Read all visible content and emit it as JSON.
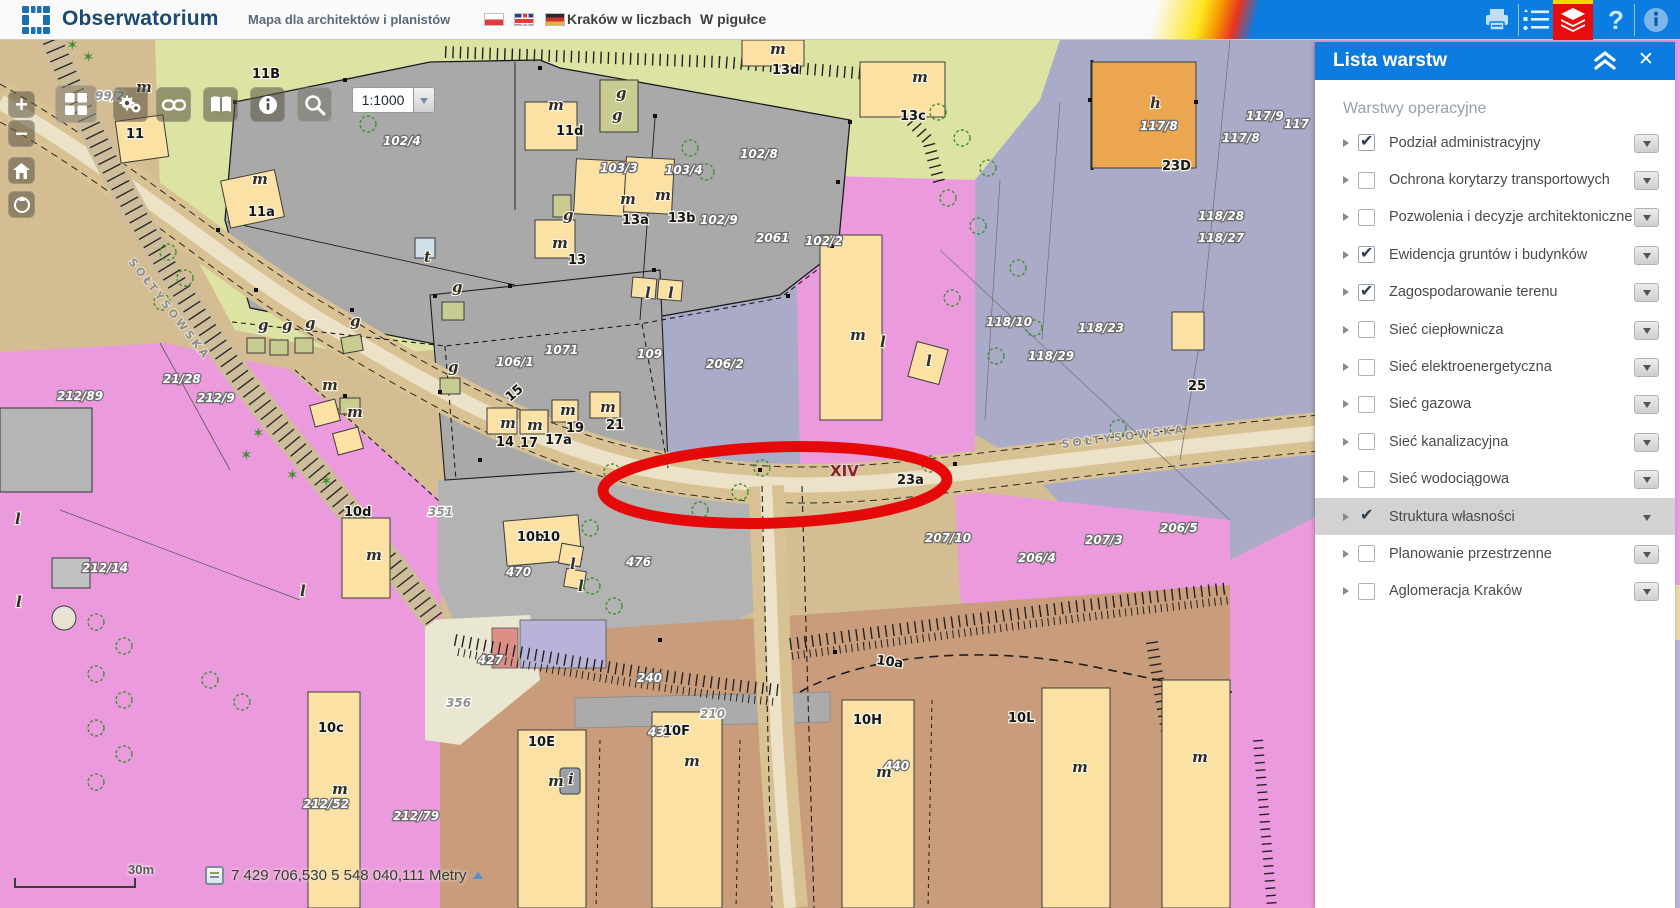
{
  "header": {
    "app_title": "Obserwatorium",
    "subtitle": "Mapa dla architektów i planistów",
    "link_numbers": "Kraków w liczbach",
    "link_pill": "W pigułce",
    "flags": [
      "flag-poland",
      "flag-uk",
      "flag-germany"
    ],
    "icons": [
      "print-icon",
      "legend-icon",
      "layers-icon",
      "help-icon",
      "info-icon"
    ],
    "accent_blue": "#0b7ce0",
    "layers_button_red": "#e80c0c"
  },
  "toolbar": {
    "scale_value": "1:1000",
    "buttons": [
      "zoom-in",
      "zoom-out",
      "home",
      "compass",
      "basemaps-grid",
      "tools-gears",
      "link",
      "book",
      "info",
      "search"
    ]
  },
  "layers_panel": {
    "title": "Lista warstw",
    "section_title": "Warstwy operacyjne",
    "layers": [
      {
        "label": "Podział administracyjny",
        "checked": true,
        "selected": false
      },
      {
        "label": "Ochrona korytarzy transportowych",
        "checked": false,
        "selected": false
      },
      {
        "label": "Pozwolenia i decyzje architektoniczne",
        "checked": false,
        "selected": false
      },
      {
        "label": "Ewidencja gruntów i budynków",
        "checked": true,
        "selected": false
      },
      {
        "label": "Zagospodarowanie terenu",
        "checked": true,
        "selected": false
      },
      {
        "label": "Sieć ciepłownicza",
        "checked": false,
        "selected": false
      },
      {
        "label": "Sieć elektroenergetyczna",
        "checked": false,
        "selected": false
      },
      {
        "label": "Sieć gazowa",
        "checked": false,
        "selected": false
      },
      {
        "label": "Sieć kanalizacyjna",
        "checked": false,
        "selected": false
      },
      {
        "label": "Sieć wodociągowa",
        "checked": false,
        "selected": false
      },
      {
        "label": "Struktura własności",
        "checked": true,
        "selected": true
      },
      {
        "label": "Planowanie przestrzenne",
        "checked": false,
        "selected": false
      },
      {
        "label": "Aglomeracja Kraków",
        "checked": false,
        "selected": false
      }
    ]
  },
  "statusbar": {
    "scalebar_label": "30m",
    "coordinates": "7 429 706,530  5 548 040,111 Metry"
  },
  "map": {
    "annotation_color": "#e60909",
    "colors": {
      "olive": "#dce3a3",
      "gray": "#a9a9a9",
      "tan": "#d4bd92",
      "road": "#d8c193",
      "pink": "#ec9ade",
      "lavender": "#a9abc9",
      "brown": "#c99c7b",
      "building_yellow": "#fbe1a3",
      "building_orange": "#eca64f",
      "building_olive": "#c9cc90"
    },
    "street_labels": [
      {
        "t": "SOŁTYSOWSKA",
        "x": 128,
        "y": 222,
        "r": 52,
        "c": "ls"
      },
      {
        "t": "SOŁTYSOWSKA",
        "x": 1062,
        "y": 408,
        "r": -7,
        "c": "ls"
      }
    ],
    "labels": [
      {
        "t": "99/2",
        "x": 95,
        "y": 60,
        "c": "lg"
      },
      {
        "t": "m",
        "x": 136,
        "y": 52,
        "c": "lm"
      },
      {
        "t": "11",
        "x": 126,
        "y": 98,
        "c": "lb"
      },
      {
        "t": "m",
        "x": 252,
        "y": 144,
        "c": "lm"
      },
      {
        "t": "11a",
        "x": 248,
        "y": 176,
        "c": "lb"
      },
      {
        "t": "11B",
        "x": 252,
        "y": 38,
        "c": "lb"
      },
      {
        "t": "102/4",
        "x": 383,
        "y": 105,
        "c": "lp"
      },
      {
        "t": "m",
        "x": 548,
        "y": 70,
        "c": "lm"
      },
      {
        "t": "11d",
        "x": 556,
        "y": 95,
        "c": "lb"
      },
      {
        "t": "g",
        "x": 616,
        "y": 58,
        "c": "lm"
      },
      {
        "t": "g",
        "x": 612,
        "y": 80,
        "c": "lm"
      },
      {
        "t": "103/3",
        "x": 600,
        "y": 132,
        "c": "lp"
      },
      {
        "t": "103/4",
        "x": 665,
        "y": 134,
        "c": "lp"
      },
      {
        "t": "102/8",
        "x": 740,
        "y": 118,
        "c": "lp"
      },
      {
        "t": "102/9",
        "x": 700,
        "y": 184,
        "c": "lp"
      },
      {
        "t": "102/2",
        "x": 805,
        "y": 205,
        "c": "lp"
      },
      {
        "t": "g",
        "x": 563,
        "y": 180,
        "c": "lm"
      },
      {
        "t": "m",
        "x": 552,
        "y": 208,
        "c": "lm"
      },
      {
        "t": "13",
        "x": 568,
        "y": 224,
        "c": "lb"
      },
      {
        "t": "m",
        "x": 620,
        "y": 164,
        "c": "lm"
      },
      {
        "t": "13a",
        "x": 622,
        "y": 184,
        "c": "lb"
      },
      {
        "t": "m",
        "x": 655,
        "y": 160,
        "c": "lm"
      },
      {
        "t": "13b",
        "x": 668,
        "y": 182,
        "c": "lb"
      },
      {
        "t": "m",
        "x": 770,
        "y": 14,
        "c": "lm"
      },
      {
        "t": "13d",
        "x": 772,
        "y": 34,
        "c": "lb"
      },
      {
        "t": "m",
        "x": 912,
        "y": 42,
        "c": "lm"
      },
      {
        "t": "13c",
        "x": 900,
        "y": 80,
        "c": "lb"
      },
      {
        "t": "t",
        "x": 424,
        "y": 222,
        "c": "lm"
      },
      {
        "t": "h",
        "x": 1150,
        "y": 68,
        "c": "lm"
      },
      {
        "t": "23D",
        "x": 1162,
        "y": 130,
        "c": "lb"
      },
      {
        "t": "117/8",
        "x": 1140,
        "y": 90,
        "c": "lp"
      },
      {
        "t": "117/9",
        "x": 1246,
        "y": 80,
        "c": "lp"
      },
      {
        "t": "117",
        "x": 1284,
        "y": 88,
        "c": "lp"
      },
      {
        "t": "117/8",
        "x": 1222,
        "y": 102,
        "c": "lp"
      },
      {
        "t": "118/28",
        "x": 1198,
        "y": 180,
        "c": "lp"
      },
      {
        "t": "118/27",
        "x": 1198,
        "y": 202,
        "c": "lp"
      },
      {
        "t": "118/10",
        "x": 986,
        "y": 286,
        "c": "lp"
      },
      {
        "t": "118/23",
        "x": 1078,
        "y": 292,
        "c": "lp"
      },
      {
        "t": "118/29",
        "x": 1028,
        "y": 320,
        "c": "lp"
      },
      {
        "t": "25",
        "x": 1188,
        "y": 350,
        "c": "lb"
      },
      {
        "t": "2061",
        "x": 756,
        "y": 202,
        "c": "lp"
      },
      {
        "t": "206/2",
        "x": 706,
        "y": 328,
        "c": "lp"
      },
      {
        "t": "109",
        "x": 637,
        "y": 318,
        "c": "lp"
      },
      {
        "t": "1071",
        "x": 545,
        "y": 314,
        "c": "lp"
      },
      {
        "t": "106/1",
        "x": 496,
        "y": 326,
        "c": "lp"
      },
      {
        "t": "15",
        "x": 510,
        "y": 362,
        "c": "lb",
        "r": -40
      },
      {
        "t": "g",
        "x": 258,
        "y": 290,
        "c": "lm"
      },
      {
        "t": "g",
        "x": 282,
        "y": 290,
        "c": "lm"
      },
      {
        "t": "g",
        "x": 305,
        "y": 288,
        "c": "lm"
      },
      {
        "t": "g",
        "x": 350,
        "y": 286,
        "c": "lm"
      },
      {
        "t": "g",
        "x": 452,
        "y": 252,
        "c": "lm"
      },
      {
        "t": "g",
        "x": 448,
        "y": 332,
        "c": "lm"
      },
      {
        "t": "m",
        "x": 322,
        "y": 350,
        "c": "lm"
      },
      {
        "t": "m",
        "x": 347,
        "y": 377,
        "c": "lm"
      },
      {
        "t": "m",
        "x": 500,
        "y": 388,
        "c": "lm"
      },
      {
        "t": "14",
        "x": 496,
        "y": 406,
        "c": "lb"
      },
      {
        "t": "m",
        "x": 527,
        "y": 390,
        "c": "lm"
      },
      {
        "t": "17",
        "x": 520,
        "y": 407,
        "c": "lb"
      },
      {
        "t": "17a",
        "x": 545,
        "y": 404,
        "c": "lb"
      },
      {
        "t": "m",
        "x": 560,
        "y": 375,
        "c": "lm"
      },
      {
        "t": "19",
        "x": 566,
        "y": 392,
        "c": "lb"
      },
      {
        "t": "m",
        "x": 600,
        "y": 372,
        "c": "lm"
      },
      {
        "t": "21",
        "x": 606,
        "y": 389,
        "c": "lb"
      },
      {
        "t": "l",
        "x": 645,
        "y": 258,
        "c": "lm"
      },
      {
        "t": "l",
        "x": 668,
        "y": 258,
        "c": "lm"
      },
      {
        "t": "XIV",
        "x": 830,
        "y": 436,
        "c": "lx"
      },
      {
        "t": "23a",
        "x": 897,
        "y": 444,
        "c": "lb"
      },
      {
        "t": "m",
        "x": 850,
        "y": 300,
        "c": "lm"
      },
      {
        "t": "l",
        "x": 880,
        "y": 307,
        "c": "lm"
      },
      {
        "t": "l",
        "x": 926,
        "y": 326,
        "c": "lm"
      },
      {
        "t": "207/10",
        "x": 925,
        "y": 502,
        "c": "lp"
      },
      {
        "t": "207/3",
        "x": 1085,
        "y": 504,
        "c": "lp"
      },
      {
        "t": "206/5",
        "x": 1160,
        "y": 492,
        "c": "lp"
      },
      {
        "t": "206/4",
        "x": 1018,
        "y": 522,
        "c": "lp"
      },
      {
        "t": "21/28",
        "x": 163,
        "y": 343,
        "c": "lp"
      },
      {
        "t": "212/89",
        "x": 57,
        "y": 360,
        "c": "lp"
      },
      {
        "t": "212/9",
        "x": 197,
        "y": 362,
        "c": "lp"
      },
      {
        "t": "10d",
        "x": 344,
        "y": 476,
        "c": "lb"
      },
      {
        "t": "m",
        "x": 366,
        "y": 520,
        "c": "lm"
      },
      {
        "t": "212/14",
        "x": 82,
        "y": 532,
        "c": "lp"
      },
      {
        "t": "l",
        "x": 300,
        "y": 556,
        "c": "lm"
      },
      {
        "t": "l",
        "x": 16,
        "y": 567,
        "c": "lm"
      },
      {
        "t": "l",
        "x": 15,
        "y": 484,
        "c": "lm"
      },
      {
        "t": "10b",
        "x": 517,
        "y": 501,
        "c": "lb"
      },
      {
        "t": "10",
        "x": 542,
        "y": 501,
        "c": "lb"
      },
      {
        "t": "l",
        "x": 570,
        "y": 529,
        "c": "lm"
      },
      {
        "t": "l",
        "x": 578,
        "y": 551,
        "c": "lm"
      },
      {
        "t": "476",
        "x": 626,
        "y": 526,
        "c": "lp"
      },
      {
        "t": "470",
        "x": 506,
        "y": 536,
        "c": "lp"
      },
      {
        "t": "351",
        "x": 428,
        "y": 476,
        "c": "lg"
      },
      {
        "t": "427",
        "x": 478,
        "y": 624,
        "c": "lp"
      },
      {
        "t": "356",
        "x": 446,
        "y": 667,
        "c": "lg"
      },
      {
        "t": "240",
        "x": 637,
        "y": 642,
        "c": "lp"
      },
      {
        "t": "210",
        "x": 700,
        "y": 678,
        "c": "lg"
      },
      {
        "t": "437",
        "x": 648,
        "y": 696,
        "c": "lp"
      },
      {
        "t": "10a",
        "x": 876,
        "y": 624,
        "c": "lb",
        "r": 8
      },
      {
        "t": "440",
        "x": 884,
        "y": 730,
        "c": "lp"
      },
      {
        "t": "10E",
        "x": 528,
        "y": 706,
        "c": "lb"
      },
      {
        "t": "m",
        "x": 548,
        "y": 746,
        "c": "lm"
      },
      {
        "t": "10F",
        "x": 663,
        "y": 695,
        "c": "lb"
      },
      {
        "t": "m",
        "x": 684,
        "y": 726,
        "c": "lm"
      },
      {
        "t": "10H",
        "x": 853,
        "y": 684,
        "c": "lb"
      },
      {
        "t": "m",
        "x": 876,
        "y": 737,
        "c": "lm"
      },
      {
        "t": "10L",
        "x": 1008,
        "y": 682,
        "c": "lb"
      },
      {
        "t": "m",
        "x": 1072,
        "y": 732,
        "c": "lm"
      },
      {
        "t": "m",
        "x": 1192,
        "y": 722,
        "c": "lm"
      },
      {
        "t": "i",
        "x": 568,
        "y": 744,
        "c": "lm"
      },
      {
        "t": "10c",
        "x": 318,
        "y": 692,
        "c": "lb"
      },
      {
        "t": "m",
        "x": 332,
        "y": 754,
        "c": "lm"
      },
      {
        "t": "212/52",
        "x": 303,
        "y": 768,
        "c": "lp"
      },
      {
        "t": "212/79",
        "x": 393,
        "y": 780,
        "c": "lp"
      }
    ],
    "trees": [
      [
        168,
        212
      ],
      [
        185,
        238
      ],
      [
        162,
        262
      ],
      [
        388,
        58
      ],
      [
        368,
        84
      ],
      [
        690,
        108
      ],
      [
        706,
        132
      ],
      [
        938,
        72
      ],
      [
        962,
        98
      ],
      [
        988,
        128
      ],
      [
        948,
        158
      ],
      [
        978,
        186
      ],
      [
        1018,
        228
      ],
      [
        952,
        258
      ],
      [
        1034,
        288
      ],
      [
        996,
        316
      ],
      [
        1118,
        388
      ],
      [
        592,
        546
      ],
      [
        614,
        566
      ],
      [
        96,
        582
      ],
      [
        124,
        606
      ],
      [
        96,
        634
      ],
      [
        124,
        660
      ],
      [
        96,
        688
      ],
      [
        124,
        714
      ],
      [
        96,
        742
      ],
      [
        210,
        640
      ],
      [
        242,
        662
      ],
      [
        612,
        432
      ],
      [
        740,
        452
      ],
      [
        762,
        428
      ],
      [
        930,
        424
      ],
      [
        700,
        470
      ],
      [
        590,
        488
      ]
    ],
    "stars": [
      [
        240,
        420
      ],
      [
        286,
        440
      ],
      [
        320,
        446
      ],
      [
        252,
        398
      ],
      [
        66,
        10
      ],
      [
        82,
        22
      ]
    ],
    "dots": [
      [
        235,
        62
      ],
      [
        345,
        40
      ],
      [
        432,
        56
      ],
      [
        540,
        28
      ],
      [
        655,
        76
      ],
      [
        850,
        82
      ],
      [
        838,
        142
      ],
      [
        832,
        206
      ],
      [
        788,
        256
      ],
      [
        654,
        230
      ],
      [
        510,
        246
      ],
      [
        435,
        256
      ],
      [
        352,
        270
      ],
      [
        256,
        250
      ],
      [
        218,
        190
      ],
      [
        345,
        356
      ],
      [
        440,
        352
      ],
      [
        480,
        420
      ],
      [
        760,
        430
      ],
      [
        955,
        424
      ],
      [
        1090,
        60
      ],
      [
        1196,
        62
      ],
      [
        660,
        600
      ],
      [
        835,
        612
      ]
    ]
  }
}
